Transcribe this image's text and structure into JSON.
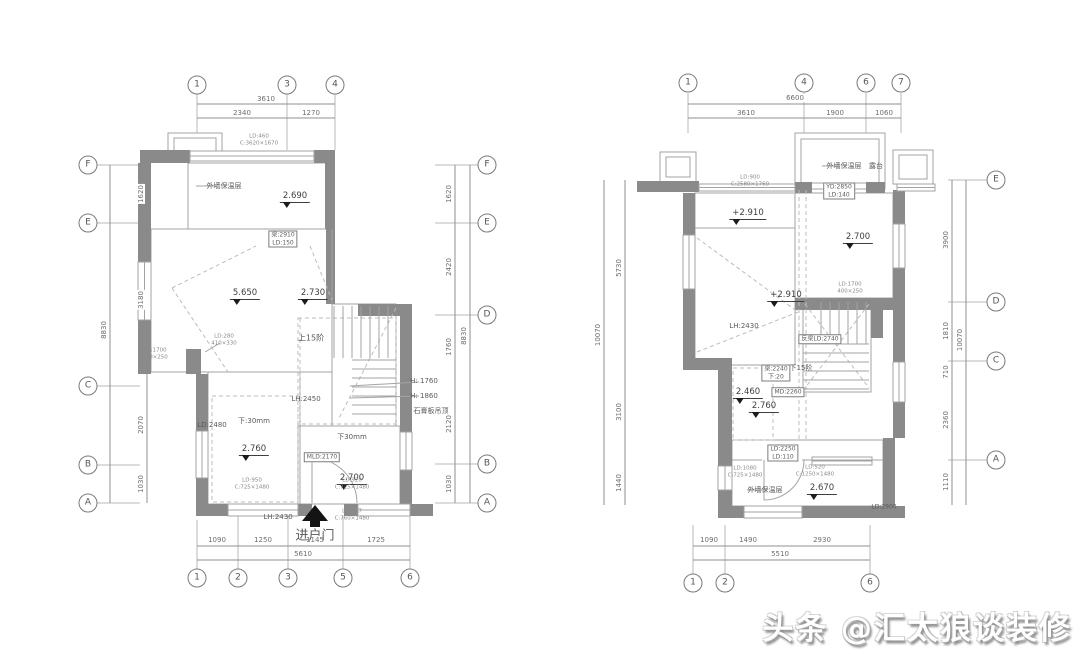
{
  "watermark": {
    "text": "头条 @汇太狼谈装修"
  },
  "palette": {
    "wall": "#8a8a8a",
    "line": "#a3a3a3",
    "grid": "#b9b9b9",
    "dim": "#8f8f8f",
    "dash": "#bcbcbc",
    "dark": "#141414",
    "window": "#ffffff"
  },
  "bubbles": [
    {
      "t": "1",
      "x": 197,
      "y": 85
    },
    {
      "t": "3",
      "x": 287,
      "y": 85
    },
    {
      "t": "4",
      "x": 335,
      "y": 85
    },
    {
      "t": "1",
      "x": 197,
      "y": 578
    },
    {
      "t": "2",
      "x": 238,
      "y": 578
    },
    {
      "t": "3",
      "x": 288,
      "y": 578
    },
    {
      "t": "5",
      "x": 343,
      "y": 578
    },
    {
      "t": "6",
      "x": 410,
      "y": 578
    },
    {
      "t": "F",
      "x": 88,
      "y": 165
    },
    {
      "t": "E",
      "x": 88,
      "y": 223
    },
    {
      "t": "C",
      "x": 88,
      "y": 386
    },
    {
      "t": "B",
      "x": 88,
      "y": 465
    },
    {
      "t": "A",
      "x": 88,
      "y": 503
    },
    {
      "t": "F",
      "x": 487,
      "y": 165
    },
    {
      "t": "E",
      "x": 487,
      "y": 223
    },
    {
      "t": "D",
      "x": 487,
      "y": 315
    },
    {
      "t": "B",
      "x": 487,
      "y": 464
    },
    {
      "t": "A",
      "x": 487,
      "y": 503
    },
    {
      "t": "1",
      "x": 688,
      "y": 83
    },
    {
      "t": "4",
      "x": 804,
      "y": 83
    },
    {
      "t": "6",
      "x": 866,
      "y": 83
    },
    {
      "t": "7",
      "x": 901,
      "y": 83
    },
    {
      "t": "1",
      "x": 693,
      "y": 583
    },
    {
      "t": "2",
      "x": 725,
      "y": 583
    },
    {
      "t": "6",
      "x": 870,
      "y": 583
    },
    {
      "t": "E",
      "x": 996,
      "y": 180
    },
    {
      "t": "D",
      "x": 996,
      "y": 302
    },
    {
      "t": "C",
      "x": 996,
      "y": 361
    },
    {
      "t": "A",
      "x": 996,
      "y": 460
    }
  ],
  "dims": [
    {
      "t": "3610",
      "x": 266,
      "y": 99,
      "r": 0
    },
    {
      "t": "2340",
      "x": 242,
      "y": 113,
      "r": 0
    },
    {
      "t": "1270",
      "x": 311,
      "y": 113,
      "r": 0
    },
    {
      "t": "1090",
      "x": 217,
      "y": 540,
      "r": 0
    },
    {
      "t": "1250",
      "x": 263,
      "y": 540,
      "r": 0
    },
    {
      "t": "1145",
      "x": 315,
      "y": 540,
      "r": 0
    },
    {
      "t": "1725",
      "x": 376,
      "y": 540,
      "r": 0
    },
    {
      "t": "5610",
      "x": 303,
      "y": 554,
      "r": 0
    },
    {
      "t": "1620",
      "x": 141,
      "y": 194,
      "r": 1
    },
    {
      "t": "3180",
      "x": 141,
      "y": 300,
      "r": 1
    },
    {
      "t": "8830",
      "x": 104,
      "y": 330,
      "r": 1
    },
    {
      "t": "2070",
      "x": 141,
      "y": 425,
      "r": 1
    },
    {
      "t": "1030",
      "x": 141,
      "y": 484,
      "r": 1
    },
    {
      "t": "1620",
      "x": 449,
      "y": 194,
      "r": 1
    },
    {
      "t": "2420",
      "x": 449,
      "y": 267,
      "r": 1
    },
    {
      "t": "1760",
      "x": 449,
      "y": 347,
      "r": 1
    },
    {
      "t": "2120",
      "x": 449,
      "y": 424,
      "r": 1
    },
    {
      "t": "1030",
      "x": 449,
      "y": 484,
      "r": 1
    },
    {
      "t": "8830",
      "x": 464,
      "y": 336,
      "r": 1
    },
    {
      "t": "6600",
      "x": 795,
      "y": 98,
      "r": 0
    },
    {
      "t": "3610",
      "x": 746,
      "y": 113,
      "r": 0
    },
    {
      "t": "1900",
      "x": 835,
      "y": 113,
      "r": 0
    },
    {
      "t": "1060",
      "x": 884,
      "y": 113,
      "r": 0
    },
    {
      "t": "1090",
      "x": 709,
      "y": 540,
      "r": 0
    },
    {
      "t": "1490",
      "x": 748,
      "y": 540,
      "r": 0
    },
    {
      "t": "2930",
      "x": 822,
      "y": 540,
      "r": 0
    },
    {
      "t": "5510",
      "x": 780,
      "y": 554,
      "r": 0
    },
    {
      "t": "5730",
      "x": 619,
      "y": 268,
      "r": 1
    },
    {
      "t": "3100",
      "x": 619,
      "y": 412,
      "r": 1
    },
    {
      "t": "1440",
      "x": 619,
      "y": 483,
      "r": 1
    },
    {
      "t": "10070",
      "x": 598,
      "y": 335,
      "r": 1
    },
    {
      "t": "3900",
      "x": 946,
      "y": 240,
      "r": 1
    },
    {
      "t": "1810",
      "x": 946,
      "y": 331,
      "r": 1
    },
    {
      "t": "710",
      "x": 946,
      "y": 372,
      "r": 1
    },
    {
      "t": "2360",
      "x": 946,
      "y": 420,
      "r": 1
    },
    {
      "t": "1110",
      "x": 946,
      "y": 482,
      "r": 1
    },
    {
      "t": "10070",
      "x": 960,
      "y": 340,
      "r": 1
    }
  ],
  "elevs": [
    {
      "t": "2.690",
      "x": 295,
      "y": 191
    },
    {
      "t": "5.650",
      "x": 245,
      "y": 288
    },
    {
      "t": "2.730",
      "x": 313,
      "y": 288
    },
    {
      "t": "2.760",
      "x": 254,
      "y": 444
    },
    {
      "t": "2.700",
      "x": 352,
      "y": 473
    },
    {
      "t": "+2.910",
      "x": 748,
      "y": 208
    },
    {
      "t": "2.700",
      "x": 858,
      "y": 232
    },
    {
      "t": "+2.910",
      "x": 786,
      "y": 290
    },
    {
      "t": "2.460",
      "x": 748,
      "y": 387
    },
    {
      "t": "2.760",
      "x": 764,
      "y": 401
    },
    {
      "t": "2.670",
      "x": 822,
      "y": 483
    }
  ],
  "labels": [
    {
      "t": "外墙保温层",
      "x": 224,
      "y": 186,
      "s": 7
    },
    {
      "t": "上15阶",
      "x": 311,
      "y": 338,
      "s": 8
    },
    {
      "t": "LD:2480",
      "x": 212,
      "y": 425,
      "s": 7
    },
    {
      "t": "下:30mm",
      "x": 254,
      "y": 421,
      "s": 7
    },
    {
      "t": "LH:2450",
      "x": 306,
      "y": 399,
      "s": 7
    },
    {
      "t": "H: 1760",
      "x": 424,
      "y": 381,
      "s": 7
    },
    {
      "t": "H: 1860",
      "x": 424,
      "y": 396,
      "s": 7
    },
    {
      "t": "石膏板吊顶",
      "x": 431,
      "y": 411,
      "s": 7
    },
    {
      "t": "下30mm",
      "x": 352,
      "y": 437,
      "s": 7
    },
    {
      "t": "LH:2430",
      "x": 278,
      "y": 517,
      "s": 7
    },
    {
      "t": "进户门",
      "x": 315,
      "y": 534,
      "s": 13
    },
    {
      "t": "外墙保温层",
      "x": 844,
      "y": 166,
      "s": 7
    },
    {
      "t": "露台",
      "x": 876,
      "y": 166,
      "s": 7
    },
    {
      "t": "LH:2430",
      "x": 744,
      "y": 326,
      "s": 7
    },
    {
      "t": "下15阶",
      "x": 801,
      "y": 368,
      "s": 7
    },
    {
      "t": "外墙保温层",
      "x": 765,
      "y": 490,
      "s": 7
    },
    {
      "t": "LD:2900",
      "x": 884,
      "y": 507,
      "s": 6
    }
  ],
  "boxes": [
    {
      "l": [
        "梁:2910",
        "LD:150"
      ],
      "x": 283,
      "y": 239
    },
    {
      "l": [
        "MLD:2170"
      ],
      "x": 322,
      "y": 457
    },
    {
      "l": [
        "YD:2850",
        "LD:140"
      ],
      "x": 839,
      "y": 191
    },
    {
      "l": [
        "反梁LD:2740"
      ],
      "x": 820,
      "y": 339
    },
    {
      "l": [
        "梁:2240",
        "下:20"
      ],
      "x": 776,
      "y": 373
    },
    {
      "l": [
        "MD:2260"
      ],
      "x": 788,
      "y": 392
    },
    {
      "l": [
        "LD:2250",
        "LD:110"
      ],
      "x": 783,
      "y": 453
    }
  ],
  "tinys": [
    {
      "l": [
        "LD:460",
        "C:3620×1670"
      ],
      "x": 259,
      "y": 140
    },
    {
      "l": [
        "LD:1700",
        "400×250"
      ],
      "x": 155,
      "y": 354
    },
    {
      "l": [
        "LD:280",
        "410×330"
      ],
      "x": 224,
      "y": 340
    },
    {
      "l": [
        "LD:950",
        "C:725×1480"
      ],
      "x": 252,
      "y": 484
    },
    {
      "l": [
        "LD:920",
        "C:725×1480"
      ],
      "x": 352,
      "y": 484
    },
    {
      "l": [
        "LD:757",
        "C:760×1480"
      ],
      "x": 352,
      "y": 515
    },
    {
      "l": [
        "LD:900",
        "C:2580×1760"
      ],
      "x": 750,
      "y": 181
    },
    {
      "l": [
        "LD:1700",
        "400×250"
      ],
      "x": 850,
      "y": 288
    },
    {
      "l": [
        "LD:1080",
        "C:725×1480"
      ],
      "x": 745,
      "y": 472
    },
    {
      "l": [
        "LD:520",
        "C:1250×1480"
      ],
      "x": 815,
      "y": 471
    }
  ],
  "walls": [
    [
      140,
      150,
      50,
      13
    ],
    [
      314,
      150,
      21,
      13
    ],
    [
      138,
      163,
      13,
      66
    ],
    [
      325,
      163,
      10,
      66
    ],
    [
      138,
      229,
      13,
      33
    ],
    [
      138,
      320,
      13,
      54
    ],
    [
      186,
      349,
      15,
      25
    ],
    [
      196,
      374,
      12,
      57
    ],
    [
      196,
      478,
      12,
      38
    ],
    [
      196,
      504,
      32,
      12
    ],
    [
      298,
      504,
      14,
      12
    ],
    [
      344,
      504,
      14,
      12
    ],
    [
      410,
      504,
      23,
      12
    ],
    [
      326,
      229,
      9,
      75
    ],
    [
      358,
      304,
      54,
      12
    ],
    [
      400,
      316,
      12,
      116
    ],
    [
      400,
      470,
      12,
      46
    ],
    [
      637,
      181,
      62,
      11
    ],
    [
      795,
      182,
      17,
      11
    ],
    [
      866,
      182,
      19,
      11
    ],
    [
      893,
      190,
      12,
      34
    ],
    [
      893,
      268,
      12,
      44
    ],
    [
      683,
      193,
      12,
      44
    ],
    [
      683,
      289,
      12,
      78
    ],
    [
      683,
      358,
      49,
      12
    ],
    [
      718,
      370,
      14,
      68
    ],
    [
      718,
      436,
      14,
      30
    ],
    [
      718,
      490,
      14,
      28
    ],
    [
      718,
      506,
      26,
      12
    ],
    [
      802,
      506,
      44,
      12
    ],
    [
      846,
      506,
      37,
      12
    ],
    [
      883,
      438,
      12,
      80
    ],
    [
      795,
      298,
      98,
      12
    ],
    [
      871,
      302,
      12,
      36
    ],
    [
      893,
      310,
      12,
      52
    ],
    [
      893,
      402,
      12,
      36
    ],
    [
      883,
      506,
      22,
      12
    ]
  ],
  "windows_v": [
    [
      138,
      262,
      13,
      58
    ],
    [
      196,
      431,
      12,
      47
    ],
    [
      400,
      432,
      12,
      38
    ],
    [
      683,
      235,
      12,
      54
    ],
    [
      893,
      224,
      12,
      44
    ],
    [
      893,
      362,
      12,
      40
    ],
    [
      718,
      466,
      14,
      24
    ]
  ],
  "windows_h": [
    [
      190,
      151,
      124,
      10
    ],
    [
      228,
      504,
      70,
      12
    ],
    [
      358,
      504,
      52,
      12
    ],
    [
      699,
      184,
      96,
      7
    ],
    [
      897,
      184,
      38,
      7
    ],
    [
      744,
      506,
      58,
      12
    ],
    [
      812,
      457,
      60,
      8
    ]
  ],
  "rooms": [
    [
      188,
      163,
      138,
      66
    ],
    [
      151,
      229,
      181,
      143
    ],
    [
      332,
      304,
      64,
      122
    ],
    [
      208,
      372,
      92,
      132
    ],
    [
      298,
      426,
      102,
      78
    ],
    [
      695,
      193,
      100,
      172
    ],
    [
      795,
      193,
      98,
      105
    ],
    [
      803,
      302,
      68,
      90
    ],
    [
      732,
      440,
      151,
      66
    ]
  ],
  "outline_boxes": [
    [
      168,
      133,
      54,
      28
    ],
    [
      174,
      138,
      42,
      18
    ],
    [
      660,
      152,
      36,
      30
    ],
    [
      666,
      157,
      24,
      20
    ],
    [
      893,
      150,
      40,
      34
    ],
    [
      899,
      155,
      28,
      24
    ],
    [
      795,
      133,
      90,
      56
    ],
    [
      801,
      139,
      78,
      44
    ]
  ],
  "lines": [
    [
      151,
      229,
      326,
      229
    ],
    [
      188,
      163,
      188,
      229
    ],
    [
      332,
      229,
      332,
      304
    ],
    [
      695,
      228,
      795,
      228
    ],
    [
      732,
      460,
      762,
      460
    ],
    [
      802,
      460,
      883,
      460
    ],
    [
      312,
      458,
      312,
      503
    ],
    [
      764,
      460,
      764,
      500
    ],
    [
      196,
      186,
      217,
      186
    ],
    [
      822,
      166,
      840,
      166
    ],
    [
      747,
      490,
      762,
      490
    ],
    [
      205,
      352,
      220,
      343
    ],
    [
      350,
      386,
      419,
      382
    ],
    [
      350,
      398,
      419,
      396
    ]
  ],
  "dashlines": [
    [
      300,
      318,
      300,
      424
    ],
    [
      799,
      190,
      799,
      442
    ],
    [
      806,
      190,
      806,
      442
    ],
    [
      172,
      288,
      256,
      246
    ],
    [
      172,
      288,
      228,
      372
    ],
    [
      310,
      246,
      332,
      300
    ],
    [
      697,
      238,
      798,
      312
    ],
    [
      697,
      352,
      798,
      312
    ],
    [
      396,
      308,
      338,
      420
    ],
    [
      869,
      304,
      805,
      388
    ],
    [
      805,
      304,
      869,
      388
    ]
  ],
  "dashboxes": [
    [
      298,
      318,
      98,
      106
    ],
    [
      212,
      396,
      86,
      106
    ],
    [
      733,
      368,
      40,
      72
    ]
  ],
  "gridlines": [
    [
      197,
      94,
      197,
      150
    ],
    [
      287,
      94,
      287,
      150
    ],
    [
      335,
      94,
      335,
      150
    ],
    [
      197,
      520,
      197,
      569
    ],
    [
      238,
      516,
      238,
      569
    ],
    [
      288,
      516,
      288,
      569
    ],
    [
      343,
      516,
      343,
      569
    ],
    [
      410,
      516,
      410,
      569
    ],
    [
      97,
      165,
      140,
      165
    ],
    [
      97,
      223,
      140,
      223
    ],
    [
      97,
      386,
      140,
      386
    ],
    [
      97,
      465,
      140,
      465
    ],
    [
      97,
      503,
      140,
      503
    ],
    [
      435,
      165,
      478,
      165
    ],
    [
      435,
      223,
      478,
      223
    ],
    [
      435,
      315,
      478,
      315
    ],
    [
      435,
      464,
      478,
      464
    ],
    [
      435,
      503,
      478,
      503
    ],
    [
      688,
      93,
      688,
      133
    ],
    [
      804,
      93,
      804,
      133
    ],
    [
      866,
      93,
      866,
      133
    ],
    [
      901,
      93,
      901,
      133
    ],
    [
      693,
      525,
      693,
      574
    ],
    [
      725,
      525,
      725,
      574
    ],
    [
      870,
      525,
      870,
      574
    ],
    [
      948,
      180,
      987,
      180
    ],
    [
      948,
      302,
      987,
      302
    ],
    [
      948,
      361,
      987,
      361
    ],
    [
      948,
      460,
      987,
      460
    ]
  ],
  "dimlines": [
    [
      197,
      104,
      335,
      104
    ],
    [
      197,
      118,
      335,
      118
    ],
    [
      197,
      546,
      410,
      546
    ],
    [
      197,
      560,
      410,
      560
    ],
    [
      147,
      165,
      147,
      503
    ],
    [
      110,
      165,
      110,
      503
    ],
    [
      455,
      165,
      455,
      503
    ],
    [
      470,
      165,
      470,
      503
    ],
    [
      688,
      104,
      901,
      104
    ],
    [
      688,
      118,
      901,
      118
    ],
    [
      693,
      546,
      870,
      546
    ],
    [
      693,
      560,
      870,
      560
    ],
    [
      604,
      180,
      604,
      505
    ],
    [
      625,
      180,
      625,
      505
    ],
    [
      952,
      180,
      952,
      505
    ],
    [
      966,
      180,
      966,
      505
    ]
  ],
  "stairs": [
    {
      "x": 334,
      "y": 306,
      "w": 62,
      "h": 52,
      "dir": "v",
      "step": 9
    },
    {
      "x": 352,
      "y": 360,
      "w": 44,
      "h": 62,
      "dir": "h",
      "step": 9
    },
    {
      "x": 821,
      "y": 302,
      "w": 50,
      "h": 42,
      "dir": "v",
      "step": 9
    },
    {
      "x": 803,
      "y": 344,
      "w": 66,
      "h": 46,
      "dir": "h",
      "step": 9
    }
  ],
  "arcs": [
    {
      "cx": 312,
      "cy": 503,
      "r": 45,
      "a0": 270,
      "a1": 360
    },
    {
      "cx": 764,
      "cy": 460,
      "r": 40,
      "a0": 0,
      "a1": 90
    }
  ],
  "entrance_arrow": {
    "tri": [
      [
        315,
        505
      ],
      [
        302,
        521
      ],
      [
        328,
        521
      ]
    ],
    "stem": [
      310,
      521,
      10,
      6
    ]
  }
}
